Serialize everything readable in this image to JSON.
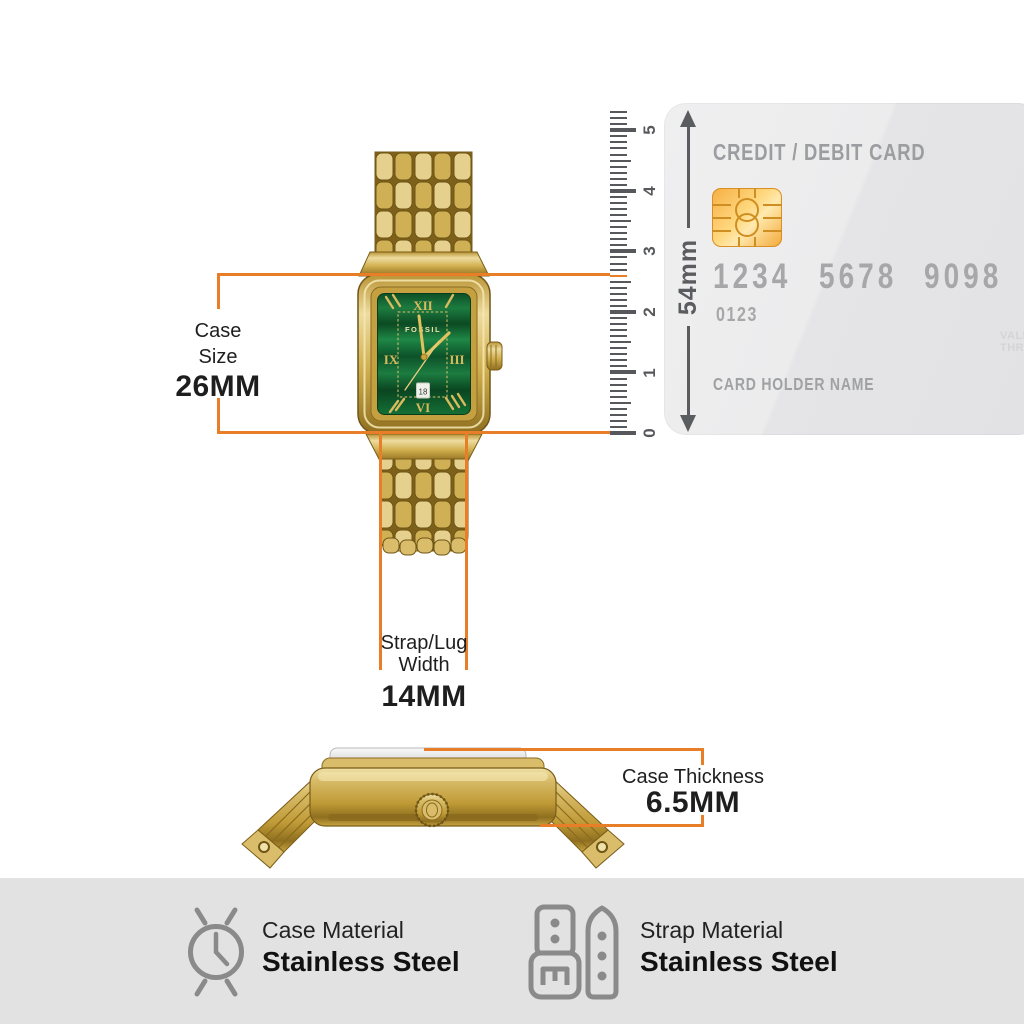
{
  "annotations": {
    "case_size": {
      "line1": "Case",
      "line2": "Size",
      "value": "26MM"
    },
    "strap_width": {
      "line1": "Strap/Lug",
      "line2": "Width",
      "value": "14MM"
    },
    "case_thickness": {
      "label": "Case Thickness",
      "value": "6.5MM"
    }
  },
  "ruler": {
    "numbers": [
      "0",
      "1",
      "2",
      "3",
      "4",
      "5"
    ],
    "measure_label": "54mm"
  },
  "card": {
    "title": "CREDIT / DEBIT CARD",
    "number_groups": [
      "1234",
      "5678",
      "9098"
    ],
    "sub_number": "0123",
    "valid_line1": "VALID",
    "valid_line2": "THRU",
    "holder_label": "CARD HOLDER NAME"
  },
  "watch": {
    "brand": "FOSSIL",
    "date": "18",
    "numerals": {
      "top": "XII",
      "right": "III",
      "bottom": "VI",
      "left": "IX"
    }
  },
  "materials": [
    {
      "icon": "watch-case-icon",
      "label": "Case Material",
      "value": "Stainless Steel"
    },
    {
      "icon": "watch-strap-icon",
      "label": "Strap Material",
      "value": "Stainless Steel"
    }
  ],
  "colors": {
    "accent_orange": "#E87E28",
    "ruler_gray": "#57585B",
    "text_dark": "#1E1E1E",
    "card_text_gray": "#A7A7A9",
    "chip_gold": "#F6AE44",
    "watch_gold": "#D4B055",
    "dial_green": "#156B38",
    "footer_bg": "#E2E2E3",
    "icon_gray": "#8A8A8A"
  }
}
